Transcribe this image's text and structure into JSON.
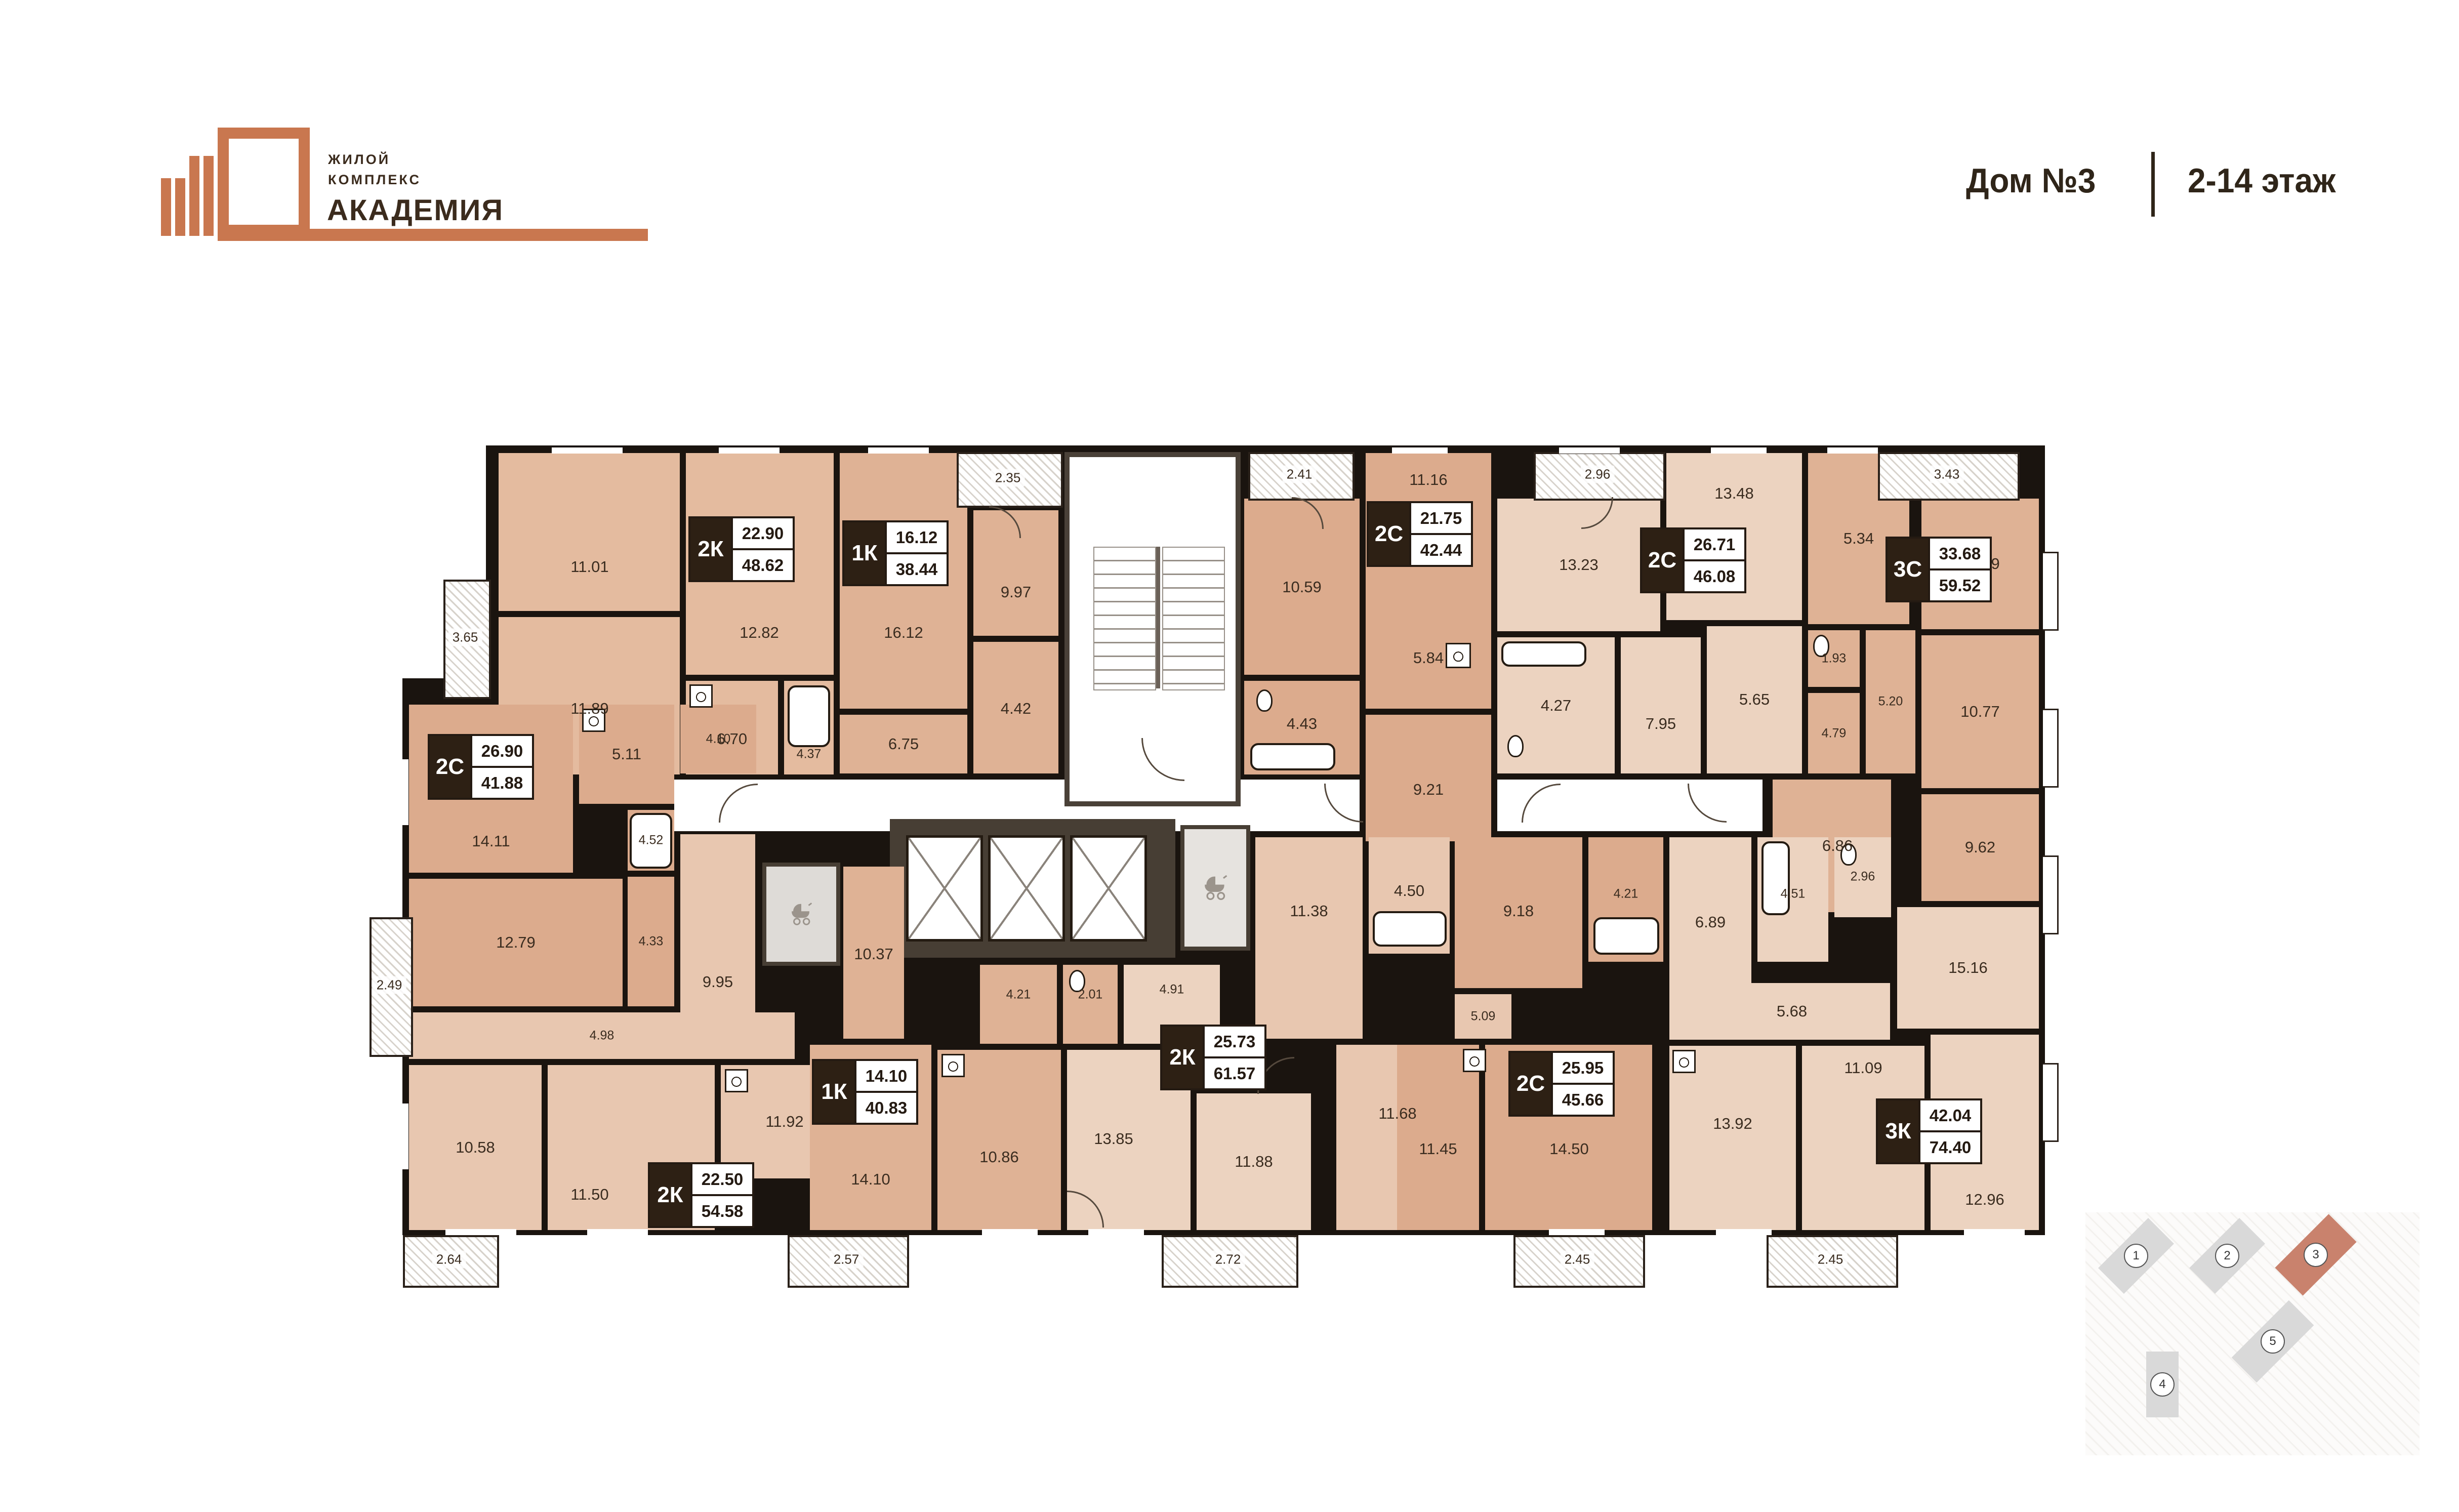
{
  "header": {
    "logo": {
      "line1": "ЖИЛОЙ",
      "line2": "КОМПЛЕКС",
      "name": "АКАДЕМИЯ"
    },
    "house": "Дом №3",
    "floors": "2-14 этаж"
  },
  "colors": {
    "accent": "#c9774f",
    "wall": "#1a140f",
    "minimap_active": "#c9826d"
  },
  "apartments": [
    {
      "type": "2К",
      "living": "22.90",
      "total": "48.62"
    },
    {
      "type": "1К",
      "living": "16.12",
      "total": "38.44"
    },
    {
      "type": "2С",
      "living": "21.75",
      "total": "42.44"
    },
    {
      "type": "2С",
      "living": "26.71",
      "total": "46.08"
    },
    {
      "type": "3С",
      "living": "33.68",
      "total": "59.52"
    },
    {
      "type": "2С",
      "living": "26.90",
      "total": "41.88"
    },
    {
      "type": "2К",
      "living": "22.50",
      "total": "54.58"
    },
    {
      "type": "1К",
      "living": "14.10",
      "total": "40.83"
    },
    {
      "type": "2К",
      "living": "25.73",
      "total": "61.57"
    },
    {
      "type": "2С",
      "living": "25.95",
      "total": "45.66"
    },
    {
      "type": "3К",
      "living": "42.04",
      "total": "74.40"
    }
  ],
  "rooms": [
    "11.01",
    "12.82",
    "11.89",
    "6.70",
    "4.37",
    "16.12",
    "9.97",
    "6.75",
    "4.42",
    "10.59",
    "11.16",
    "5.84",
    "4.43",
    "9.21",
    "13.23",
    "13.48",
    "4.27",
    "7.95",
    "5.65",
    "5.34",
    "13.29",
    "1.93",
    "4.79",
    "5.20",
    "10.77",
    "6.86",
    "9.62",
    "14.11",
    "5.11",
    "4.10",
    "4.52",
    "12.79",
    "4.33",
    "9.95",
    "4.98",
    "10.58",
    "11.50",
    "11.92",
    "10.37",
    "14.10",
    "4.21",
    "2.01",
    "4.91",
    "10.86",
    "13.85",
    "11.88",
    "11.38",
    "4.50",
    "11.68",
    "5.09",
    "9.18",
    "4.21",
    "11.45",
    "14.50",
    "6.89",
    "4.51",
    "2.96",
    "5.68",
    "15.16",
    "13.92",
    "11.09",
    "12.96"
  ],
  "balconies": [
    "3.65",
    "2.35",
    "2.41",
    "2.96",
    "3.43",
    "2.49",
    "2.64",
    "2.57",
    "2.72",
    "2.45",
    "2.45"
  ],
  "minimap": {
    "buildings": [
      "1",
      "2",
      "3",
      "4",
      "5"
    ],
    "active": "3"
  }
}
